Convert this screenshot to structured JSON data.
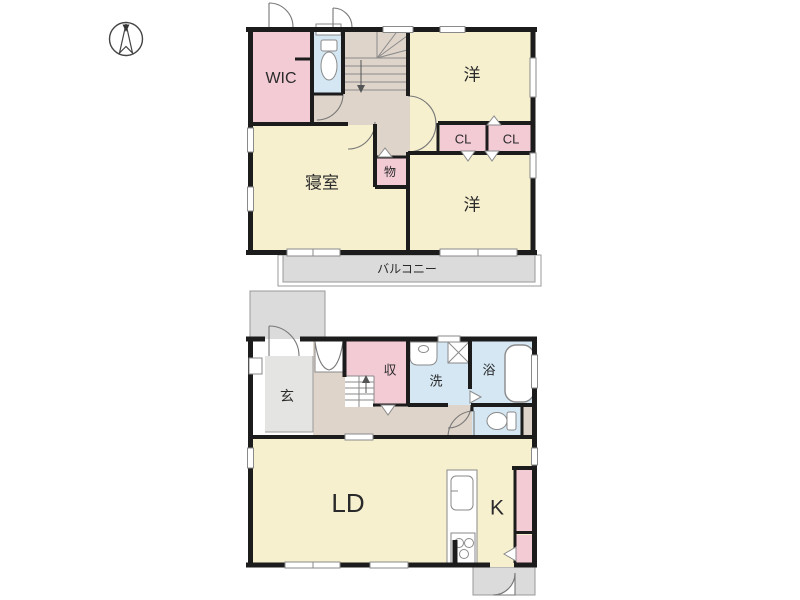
{
  "colors": {
    "wall": "#1c1c1c",
    "room_cream": "#f6f0cf",
    "closet_pink": "#f3cbd5",
    "wet_area_blue": "#d4e7f3",
    "hall_beige": "#ded4ca",
    "outdoor_gray": "#dbdbdb",
    "genkan_gray": "#e4e4e2",
    "line_gray": "#8a8a8a"
  },
  "floor2": {
    "wic": "WIC",
    "room_top": "洋",
    "closet1": "CL",
    "closet2": "CL",
    "bedroom": "寝室",
    "storage": "物",
    "room_bottom": "洋",
    "balcony": "バルコニー"
  },
  "floor1": {
    "entrance": "玄",
    "storage": "収",
    "washroom": "洗",
    "bath": "浴",
    "living_dining": "LD",
    "kitchen": "K"
  }
}
